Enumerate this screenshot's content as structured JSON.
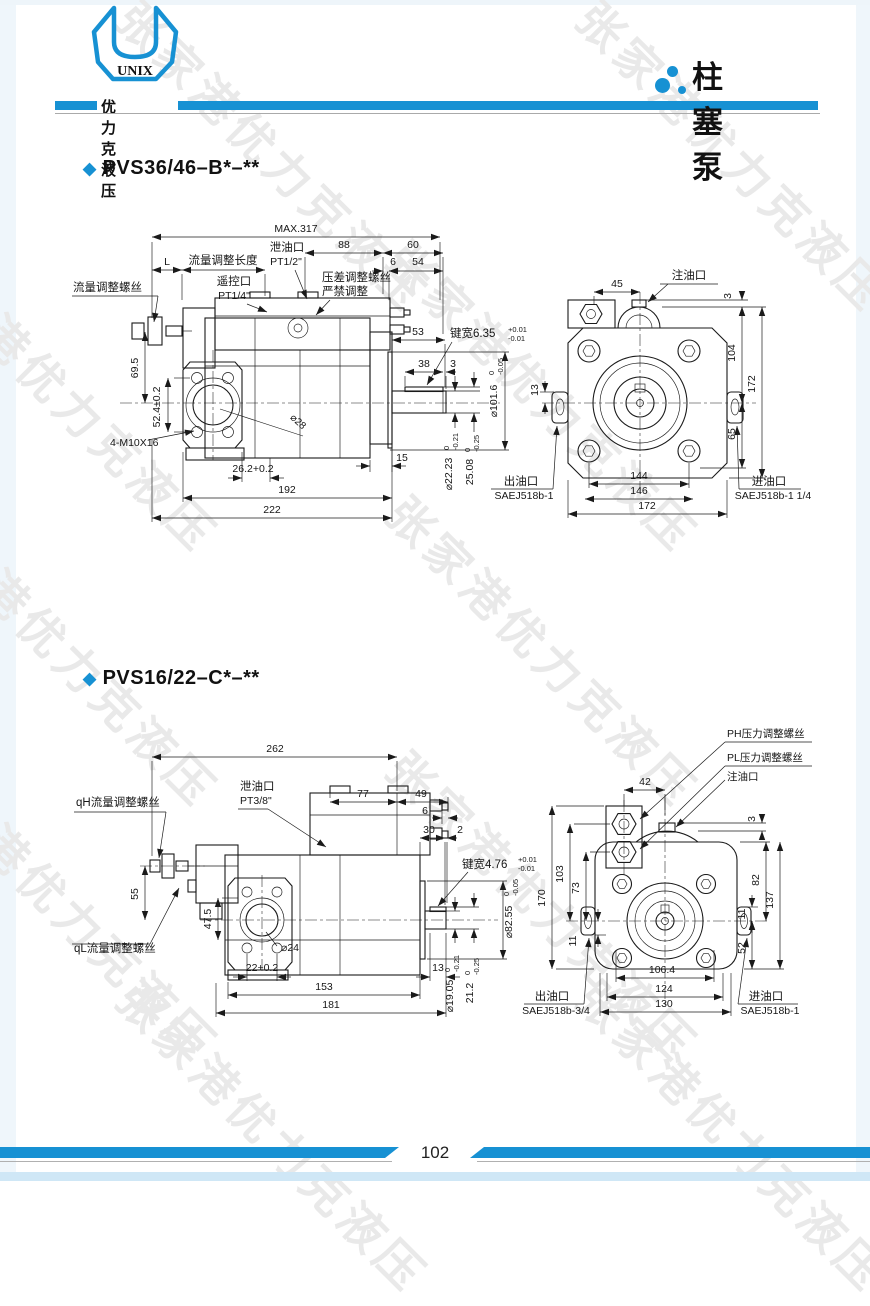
{
  "colors": {
    "accent": "#1791d3",
    "watermark": "#e9e9e9",
    "line": "#1a1a1a"
  },
  "watermark": {
    "text": "张家港优力克液压"
  },
  "header": {
    "logo_text": "UNIX",
    "brand": "优力克液压",
    "product_title": "柱塞泵"
  },
  "footer": {
    "page_number": "102"
  },
  "fig1": {
    "title": "PVS36/46–B*–**",
    "side": {
      "max": "MAX.317",
      "L": "L",
      "flow_len": "流量调整长度",
      "drain": "泄油口",
      "drain_size": "PT1/2\"",
      "d88": "88",
      "d60": "60",
      "d6": "6",
      "d54": "54",
      "remote": "遥控口",
      "remote_size": "PT1/4\"",
      "diff1": "压差调整螺丝",
      "diff2": "严禁调整",
      "d53": "53",
      "key_label": "键宽6.35",
      "key_tp": "+0.01",
      "key_tm": "-0.01",
      "d38": "38",
      "d3": "3",
      "dia101": "⌀101.6",
      "t0a": "0",
      "tma": "-0.05",
      "flow_screw": "流量调整螺丝",
      "d695": "69.5",
      "d524": "52.4±0.2",
      "bolts": "4-M10X16",
      "dia28": "⌀28",
      "d262": "26.2+0.2",
      "d192": "192",
      "d222": "222",
      "d15": "15",
      "dia2223": "⌀22.23",
      "t0b": "0",
      "tmb": "-0.21",
      "d2508": "25.08",
      "t0c": "0",
      "tmc": "-0.25"
    },
    "front": {
      "fill": "注油口",
      "d45": "45",
      "d3": "3",
      "d104": "104",
      "d172r": "172",
      "d13": "13",
      "d65": "65",
      "d144": "144",
      "d146": "146",
      "d172b": "172",
      "outlet": "出油口",
      "outlet_size": "SAEJ518b-1",
      "inlet": "进油口",
      "inlet_size": "SAEJ518b-1 1/4"
    }
  },
  "fig2": {
    "title": "PVS16/22–C*–**",
    "side": {
      "d262": "262",
      "drain": "泄油口",
      "drain_size": "PT3/8\"",
      "d77": "77",
      "d49": "49",
      "d6": "6",
      "d30": "30",
      "d2": "2",
      "key_label": "键宽4.76",
      "key_tp": "+0.01",
      "key_tm": "-0.01",
      "dia8255": "⌀82.55",
      "t0a": "0",
      "tma": "-0.05",
      "qh": "qH流量调整螺丝",
      "ql": "qL流量调整螺丝",
      "d55": "55",
      "d475": "47.5",
      "dia24": "⌀24",
      "d22": "22+0.2",
      "d153": "153",
      "d181": "181",
      "d13": "13",
      "dia1905": "⌀19.05",
      "t0b": "0",
      "tmb": "-0.21",
      "d212": "21.2",
      "t0c": "0",
      "tmc": "-0.25"
    },
    "front": {
      "ph": "PH压力调整螺丝",
      "pl": "PL压力调整螺丝",
      "fill": "注油口",
      "d42": "42",
      "d3": "3",
      "d170": "170",
      "d103": "103",
      "d73": "73",
      "d11l": "11",
      "d11r": "11",
      "d52": "52",
      "d82": "82",
      "d137": "137",
      "d1064": "106.4",
      "d124": "124",
      "d130": "130",
      "outlet": "出油口",
      "outlet_size": "SAEJ518b-3/4",
      "inlet": "进油口",
      "inlet_size": "SAEJ518b-1"
    }
  }
}
